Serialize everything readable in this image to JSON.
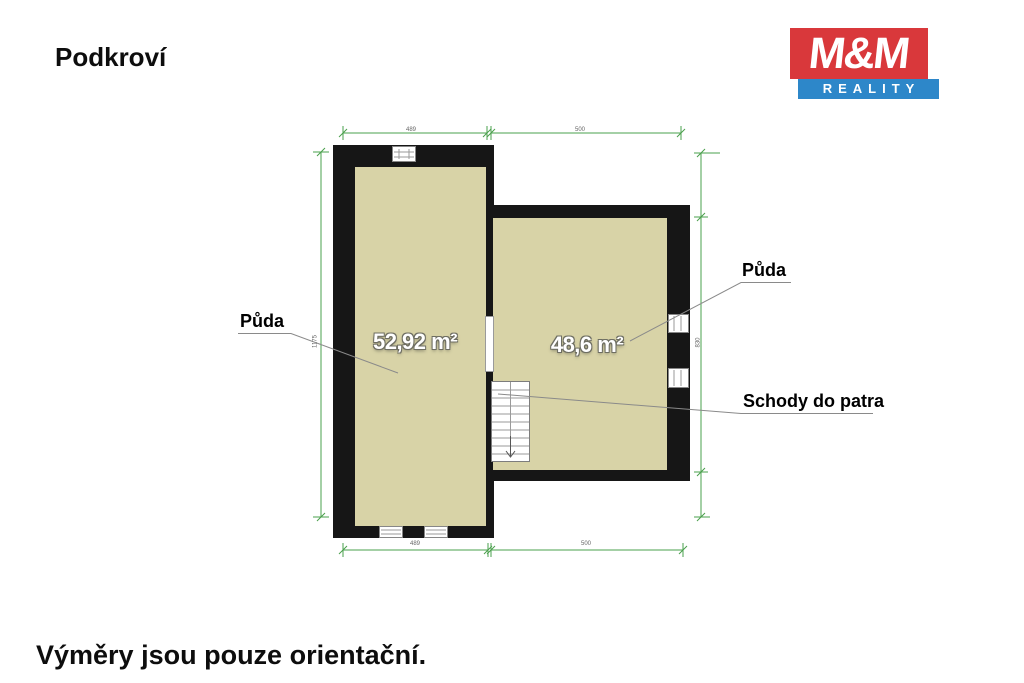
{
  "page": {
    "title": "Podkroví",
    "footer_note": "Výměry jsou pouze orientační."
  },
  "logo": {
    "name": "M&M",
    "subtitle": "REALITY"
  },
  "colors": {
    "floor": "#d8d3a7",
    "wall": "#161616",
    "green": "#4aa04c",
    "leader": "#8a8a8a",
    "red": "#d9383b",
    "blue": "#2d87c9",
    "area-text": "#ffffff"
  },
  "floorplan": {
    "rooms": [
      {
        "label": "Půda",
        "area": "52,92 m²"
      },
      {
        "label": "Půda",
        "area": "48,6 m²"
      }
    ],
    "stairs_label": "Schody do patra",
    "dimensions": {
      "top_left": "489",
      "top_right": "500",
      "bottom_left": "489",
      "bottom_right": "500",
      "left_side": "1175",
      "right_side": "830"
    }
  }
}
